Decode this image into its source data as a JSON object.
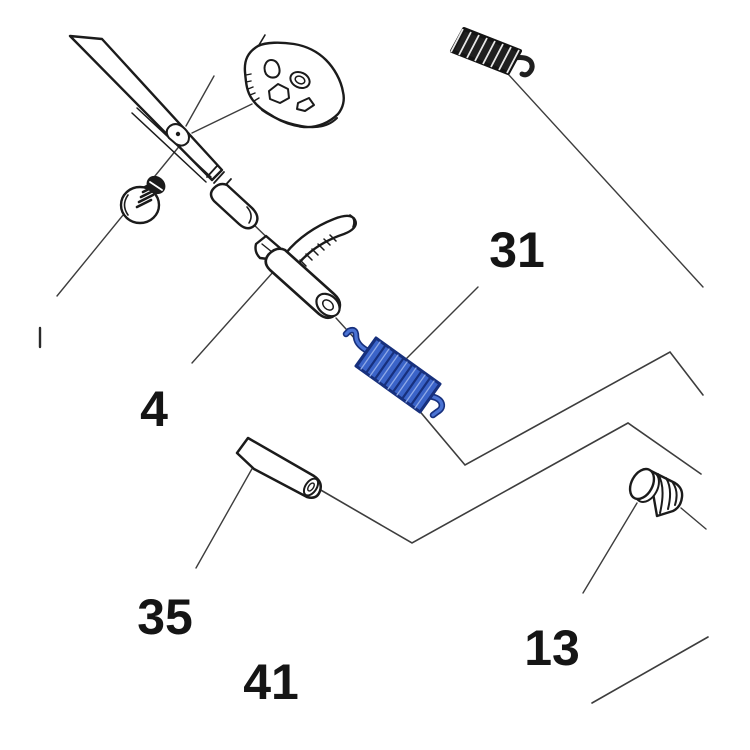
{
  "diagram": {
    "kind": "exploded-parts-diagram",
    "background_color": "#ffffff",
    "ink_color": "#1b1b1b",
    "leader_line_color": "#3d3d3d",
    "highlight_color": "#3a63c8",
    "highlight_dark_color": "#17307d",
    "callouts": [
      {
        "label": "31",
        "part": "blue-coil-spring"
      },
      {
        "label": "4",
        "part": "lever-with-barrel"
      },
      {
        "label": "35",
        "part": "cylindrical-pin"
      },
      {
        "label": "41",
        "part": "linkage-polyline"
      },
      {
        "label": "13",
        "part": "ribbed-plug"
      }
    ]
  }
}
